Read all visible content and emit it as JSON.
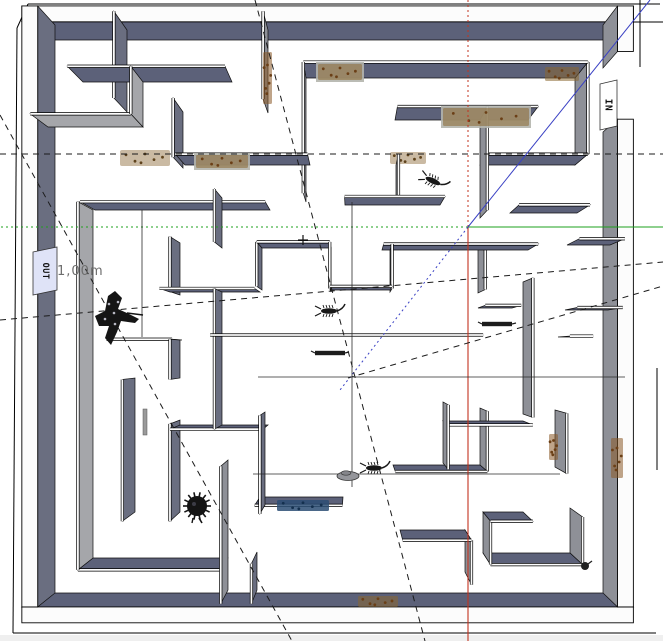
{
  "app": {
    "name": "3d-model-viewport",
    "description": "top view of a 3D walled maze model"
  },
  "labels": {
    "dimension": "1,00m",
    "sign_in": "IN",
    "sign_out": "OUT"
  },
  "colors": {
    "wall_dark": "#5c6179",
    "wall_dark2": "#6a6e80",
    "wall_gray": "#8e9097",
    "wall_light": "#a5a6aa",
    "wall_top": "#fcfcfc",
    "edge": "#101010",
    "axis_red": "#c2331f",
    "axis_green": "#1ea11e",
    "axis_blue": "#3a41c4",
    "guide": "#1b1b1b",
    "dirt": "#8a6732",
    "dirt_dark": "#5f431c",
    "rust": "#8a5a28",
    "graffiti": "#2b4d74",
    "board": "#b4b5ad",
    "sign_out_bg": "#dfe3f7",
    "sign_in_bg": "#ffffff",
    "dim_text": "#6e6e6e",
    "bottom_strip": "#efefef"
  },
  "scene": {
    "center": [
      353,
      353
    ],
    "k": 0.058,
    "slab_edges": [
      [
        28,
        4,
        660,
        4
      ],
      [
        17,
        28,
        13,
        633
      ],
      [
        13,
        633,
        656,
        633
      ],
      [
        28,
        4,
        17,
        28
      ],
      [
        640,
        0,
        640,
        67
      ],
      [
        628,
        22,
        663,
        22
      ],
      [
        657,
        368,
        657,
        470
      ]
    ],
    "outer_walls": [
      {
        "x": 40,
        "y": 25,
        "w": 578,
        "h": 15,
        "face": "S",
        "c": "wall_dark"
      },
      {
        "x": 40,
        "y": 593,
        "w": 578,
        "h": 15,
        "face": "N",
        "c": "wall_dark"
      },
      {
        "x": 40,
        "y": 25,
        "w": 15,
        "h": 568,
        "face": "E",
        "c": "wall_dark2"
      },
      {
        "x": 603,
        "y": 25,
        "w": 15,
        "h": 43,
        "face": "W",
        "c": "wall_gray"
      },
      {
        "x": 603,
        "y": 132,
        "w": 15,
        "h": 461,
        "face": "W",
        "c": "wall_gray"
      }
    ],
    "walls": [
      [
        83,
        82,
        232,
        82,
        "wall_dark"
      ],
      [
        127,
        30,
        127,
        112,
        "wall_dark2"
      ],
      [
        48,
        127,
        143,
        127,
        "wall_light"
      ],
      [
        143,
        82,
        143,
        127,
        "wall_light"
      ],
      [
        183,
        112,
        183,
        168,
        "wall_dark2"
      ],
      [
        95,
        210,
        270,
        210,
        "wall_dark"
      ],
      [
        222,
        198,
        222,
        248,
        "wall_dark2"
      ],
      [
        93,
        210,
        93,
        558,
        "wall_light"
      ],
      [
        93,
        558,
        228,
        558,
        "wall_dark"
      ],
      [
        228,
        460,
        228,
        590,
        "wall_gray"
      ],
      [
        120,
        340,
        182,
        340,
        "wall_dark"
      ],
      [
        135,
        378,
        135,
        512,
        "wall_dark2"
      ],
      [
        180,
        340,
        180,
        378,
        "wall_dark2"
      ],
      [
        180,
        420,
        180,
        512,
        "wall_dark2"
      ],
      [
        180,
        243,
        180,
        295,
        "wall_dark2"
      ],
      [
        170,
        292,
        260,
        292,
        "wall_dark"
      ],
      [
        222,
        292,
        222,
        425,
        "wall_dark2"
      ],
      [
        218,
        336,
        476,
        336,
        "wall_dark"
      ],
      [
        262,
        248,
        331,
        248,
        "wall_dark"
      ],
      [
        262,
        248,
        262,
        290,
        "wall_dark2"
      ],
      [
        331,
        248,
        331,
        292,
        "wall_gray"
      ],
      [
        331,
        290,
        390,
        290,
        "wall_dark"
      ],
      [
        390,
        250,
        390,
        292,
        "wall_gray"
      ],
      [
        345,
        205,
        440,
        205,
        "wall_dark"
      ],
      [
        396,
        165,
        396,
        205,
        "wall_gray"
      ],
      [
        185,
        165,
        310,
        165,
        "wall_dark"
      ],
      [
        306,
        78,
        306,
        202,
        "wall_gray"
      ],
      [
        306,
        78,
        575,
        78,
        "wall_dark"
      ],
      [
        268,
        30,
        268,
        113,
        "wall_gray"
      ],
      [
        395,
        120,
        528,
        120,
        "wall_dark"
      ],
      [
        480,
        120,
        480,
        218,
        "wall_gray"
      ],
      [
        480,
        165,
        575,
        165,
        "wall_dark"
      ],
      [
        575,
        78,
        575,
        165,
        "wall_gray"
      ],
      [
        510,
        213,
        577,
        213,
        "wall_dark"
      ],
      [
        567,
        245,
        610,
        245,
        "wall_dark"
      ],
      [
        382,
        250,
        528,
        250,
        "wall_dark"
      ],
      [
        478,
        250,
        478,
        293,
        "wall_gray"
      ],
      [
        478,
        308,
        512,
        308,
        "wall_dark"
      ],
      [
        558,
        337,
        580,
        337,
        "wall_dark"
      ],
      [
        565,
        310,
        608,
        310,
        "wall_dark"
      ],
      [
        523,
        282,
        523,
        414,
        "wall_gray"
      ],
      [
        443,
        421,
        523,
        421,
        "wall_dark"
      ],
      [
        443,
        402,
        443,
        463,
        "wall_gray"
      ],
      [
        265,
        412,
        265,
        505,
        "wall_dark2"
      ],
      [
        260,
        497,
        343,
        497,
        "wall_dark"
      ],
      [
        257,
        552,
        257,
        590,
        "wall_dark2"
      ],
      [
        180,
        425,
        268,
        425,
        "wall_dark"
      ],
      [
        480,
        408,
        480,
        465,
        "wall_gray"
      ],
      [
        393,
        465,
        480,
        465,
        "wall_dark"
      ],
      [
        555,
        410,
        555,
        467,
        "wall_gray"
      ],
      [
        400,
        530,
        465,
        530,
        "wall_dark"
      ],
      [
        465,
        530,
        465,
        572,
        "wall_gray"
      ],
      [
        483,
        512,
        523,
        512,
        "wall_dark"
      ],
      [
        483,
        512,
        483,
        553,
        "wall_gray"
      ],
      [
        483,
        553,
        570,
        553,
        "wall_dark"
      ],
      [
        570,
        508,
        570,
        553,
        "wall_gray"
      ]
    ],
    "axes": {
      "origin": [
        468,
        227
      ],
      "red_dotted_to": [
        468,
        0
      ],
      "red_solid_to": [
        468,
        641
      ],
      "green_dotted_to": [
        0,
        227
      ],
      "green_solid_to": [
        663,
        227
      ],
      "blue_solid_to": [
        650,
        0
      ],
      "blue_dotted_to": [
        340,
        390
      ]
    },
    "guides_dashed": [
      [
        0,
        154,
        663,
        154
      ],
      [
        0,
        320,
        663,
        262
      ],
      [
        0,
        115,
        292,
        641
      ],
      [
        255,
        0,
        425,
        641
      ],
      [
        348,
        378,
        663,
        286
      ]
    ],
    "guides_thin": [
      [
        352,
        202,
        352,
        487
      ],
      [
        258,
        377,
        625,
        377
      ],
      [
        253,
        474,
        560,
        474
      ],
      [
        142,
        210,
        142,
        337
      ]
    ],
    "ground_patches": [
      {
        "x": 120,
        "y": 150,
        "w": 50,
        "h": 16
      },
      {
        "x": 390,
        "y": 152,
        "w": 36,
        "h": 12
      }
    ],
    "top_patches": [
      {
        "x": 318,
        "y": 64,
        "w": 44,
        "h": 16,
        "kind": "dirt",
        "board": true
      },
      {
        "x": 443,
        "y": 108,
        "w": 86,
        "h": 18,
        "kind": "dirt",
        "board": true
      },
      {
        "x": 545,
        "y": 67,
        "w": 34,
        "h": 14,
        "kind": "dirt",
        "board": false
      },
      {
        "x": 196,
        "y": 155,
        "w": 52,
        "h": 13,
        "kind": "dirt",
        "board": true
      },
      {
        "x": 277,
        "y": 500,
        "w": 52,
        "h": 11,
        "kind": "graffiti",
        "board": false
      },
      {
        "x": 358,
        "y": 596,
        "w": 40,
        "h": 11,
        "kind": "dirt",
        "board": false
      },
      {
        "x": 611,
        "y": 438,
        "w": 12,
        "h": 40,
        "kind": "rust",
        "board": false
      },
      {
        "x": 549,
        "y": 434,
        "w": 9,
        "h": 26,
        "kind": "rust",
        "board": false
      },
      {
        "x": 263,
        "y": 52,
        "w": 9,
        "h": 52,
        "kind": "rust",
        "board": false
      }
    ],
    "signs": {
      "in": {
        "quad": [
          [
            600,
            84
          ],
          [
            617,
            80
          ],
          [
            617,
            126
          ],
          [
            600,
            130
          ]
        ],
        "cx": 608,
        "cy": 105
      },
      "out": {
        "quad": [
          [
            33,
            252
          ],
          [
            57,
            247
          ],
          [
            57,
            290
          ],
          [
            33,
            295
          ]
        ],
        "cx": 45,
        "cy": 271
      }
    },
    "sprites": [
      {
        "type": "person",
        "x": 113,
        "y": 316
      },
      {
        "type": "hedgehog",
        "x": 197,
        "y": 506
      },
      {
        "type": "scorpion",
        "x": 329,
        "y": 311,
        "r": 0
      },
      {
        "type": "scorpion",
        "x": 433,
        "y": 181,
        "r": 25
      },
      {
        "type": "scorpion",
        "x": 374,
        "y": 468,
        "r": 0
      },
      {
        "type": "bar",
        "x": 330,
        "y": 353
      },
      {
        "type": "bar",
        "x": 497,
        "y": 324
      },
      {
        "type": "disc",
        "x": 348,
        "y": 476
      },
      {
        "type": "plus",
        "x": 303,
        "y": 240
      },
      {
        "type": "blob",
        "x": 585,
        "y": 566
      },
      {
        "type": "stick",
        "x": 145,
        "y": 422
      }
    ]
  }
}
